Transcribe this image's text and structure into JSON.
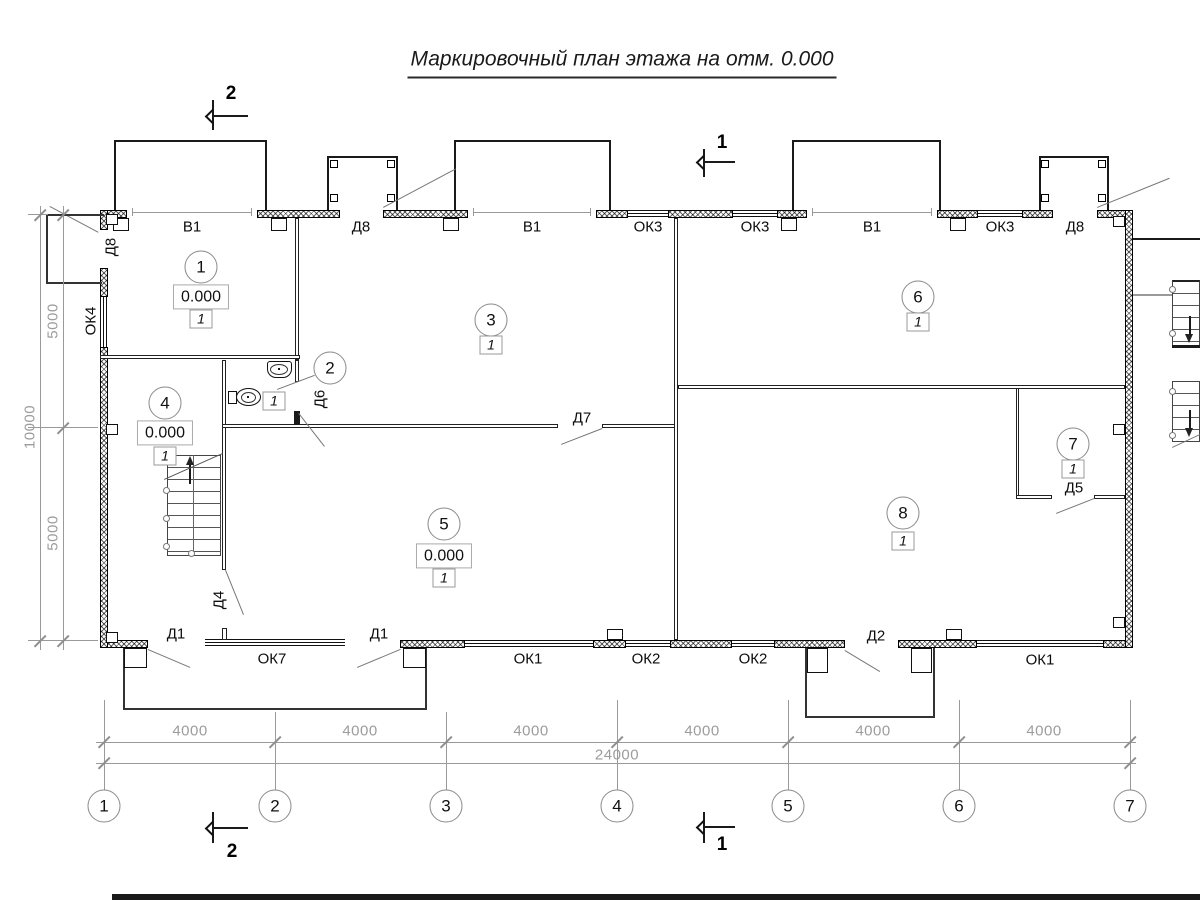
{
  "title": "Маркировочный план этажа на отм. 0.000",
  "plan": {
    "top_openings": [
      {
        "label": "В1"
      },
      {
        "label": "Д8"
      },
      {
        "label": "В1"
      },
      {
        "label": "ОК3"
      },
      {
        "label": "ОК3"
      },
      {
        "label": "В1"
      },
      {
        "label": "ОК3"
      },
      {
        "label": "Д8"
      }
    ],
    "bottom_openings": [
      {
        "label": "Д1"
      },
      {
        "label": "ОК7"
      },
      {
        "label": "Д1"
      },
      {
        "label": "ОК1"
      },
      {
        "label": "ОК2"
      },
      {
        "label": "ОК2"
      },
      {
        "label": "Д2"
      },
      {
        "label": "ОК1"
      }
    ],
    "left_openings": [
      {
        "label": "Д8"
      },
      {
        "label": "ОК4"
      }
    ],
    "interior_doors": [
      {
        "label": "Д6"
      },
      {
        "label": "Д7"
      },
      {
        "label": "Д4"
      },
      {
        "label": "Д5"
      }
    ],
    "rooms": [
      {
        "number": "1",
        "elevation": "0.000",
        "type_mark": "1"
      },
      {
        "number": "2",
        "type_mark": "1"
      },
      {
        "number": "3",
        "type_mark": "1"
      },
      {
        "number": "4",
        "elevation": "0.000",
        "type_mark": "1"
      },
      {
        "number": "5",
        "elevation": "0.000",
        "type_mark": "1"
      },
      {
        "number": "6",
        "type_mark": "1"
      },
      {
        "number": "7",
        "type_mark": "1"
      },
      {
        "number": "8",
        "type_mark": "1"
      }
    ],
    "axes": [
      "1",
      "2",
      "3",
      "4",
      "5",
      "6",
      "7"
    ],
    "dimensions": {
      "bottom_segments": [
        "4000",
        "4000",
        "4000",
        "4000",
        "4000",
        "4000"
      ],
      "bottom_total": "24000",
      "left_segments": [
        "5000",
        "5000"
      ],
      "left_total": "10000"
    },
    "section_marks": {
      "top": "2",
      "middle": "1",
      "bottom_left": "2",
      "bottom_right": "1"
    }
  }
}
